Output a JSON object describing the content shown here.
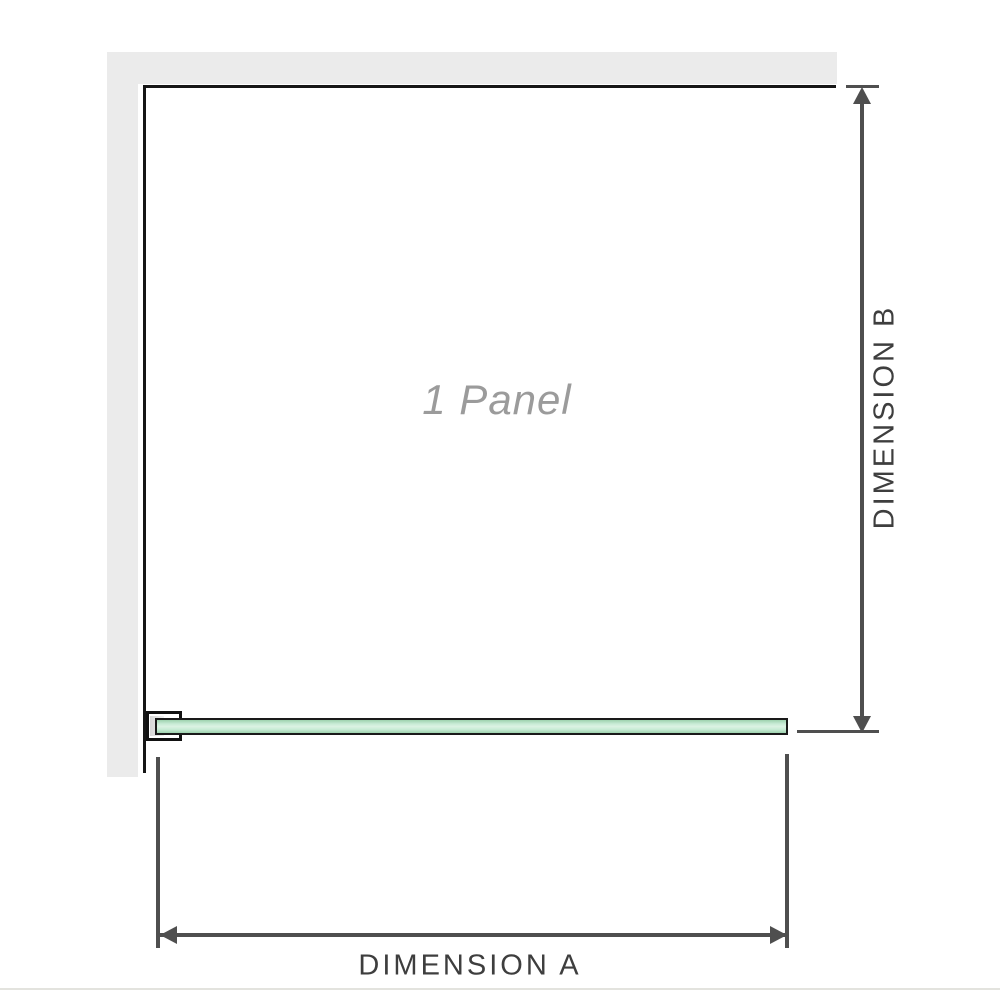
{
  "diagram": {
    "labels": {
      "panel": "1 Panel",
      "dimension_a": "DIMENSION A",
      "dimension_b": "DIMENSION B"
    },
    "colors": {
      "wall_fill": "#ebebeb",
      "panel_outline": "#161616",
      "glass_border": "#1a1a1a",
      "glass_green_edge": "#9ed2ae",
      "glass_green_center": "#dbf2e3",
      "dimension_line": "#4f4f4f",
      "dimension_text": "#3e3e3e",
      "panel_text": "#9b9b9b",
      "bottom_rule": "#e3e3de"
    },
    "icons": {
      "arrow_up": "arrow-up-icon",
      "arrow_down": "arrow-down-icon",
      "arrow_left": "arrow-left-icon",
      "arrow_right": "arrow-right-icon"
    }
  }
}
